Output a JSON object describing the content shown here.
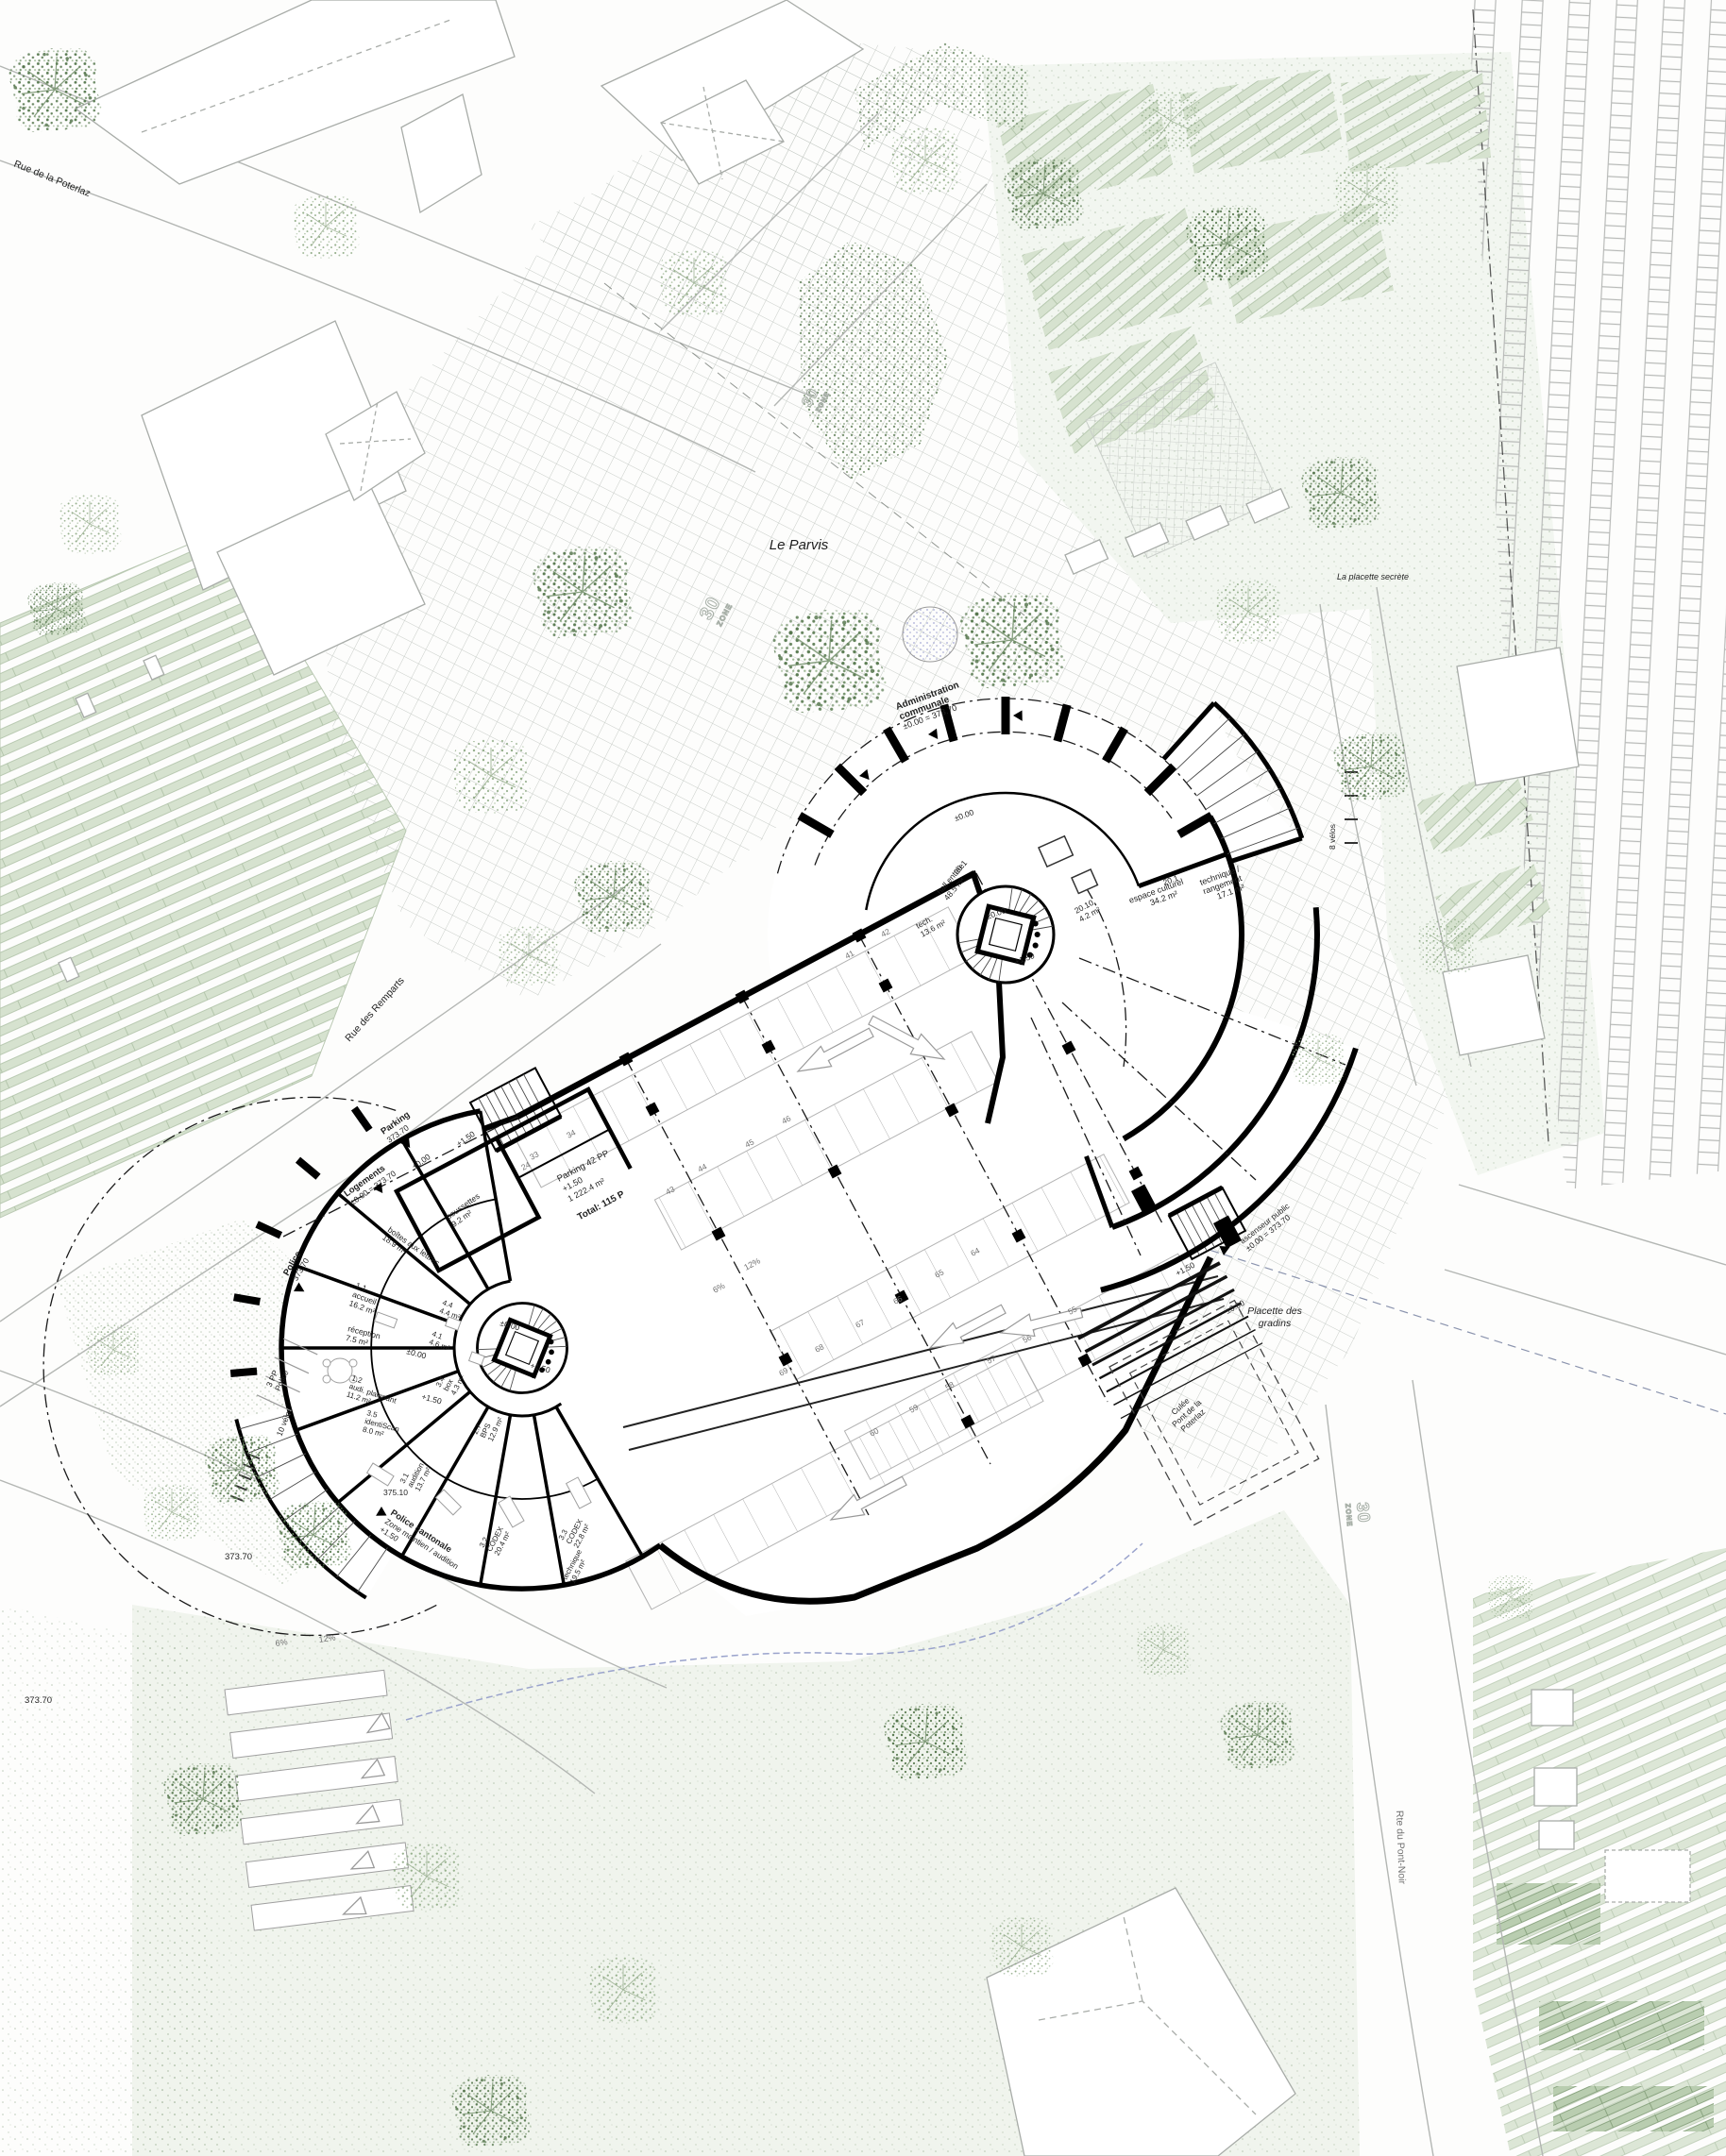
{
  "colors": {
    "wall": "#000000",
    "paving_grid": "#c8cdc8",
    "foliage_dark": "#5c7e54",
    "foliage_light": "#93ae8a",
    "lawn_dot": "#87a07f",
    "water": "#a7abd6",
    "road_line": "#b3b6b3"
  },
  "streets": {
    "rue_poterlaz": "Rue de la Poterlaz",
    "rue_remparts": "Rue des Remparts",
    "rte_pont_noir": "Rte du Pont-Noir"
  },
  "places": {
    "parvis": "Le Parvis",
    "placette_secrete": "La placette secrète",
    "gradins_1": "Placette des",
    "gradins_2": "gradins",
    "culee_1": "Culée",
    "culee_2": "Pont de la",
    "culee_3": "Poterlaz"
  },
  "annotations": {
    "admin_1": "Administration",
    "admin_2": "communale",
    "admin_3": "±0.00 = 373.70",
    "logements_1": "Logements",
    "logements_2": "±0.00 = 373.70",
    "parking_entry_1": "Parking",
    "parking_entry_2": "373.70",
    "police_corner_1": "Police",
    "police_corner_2": "373.70",
    "police_cantonale_1": "Police cantonale",
    "police_cantonale_2": "Zone maintien / audition",
    "police_cantonale_3": "+1.50",
    "ascenseur_1": "ascenseur public",
    "ascenseur_2": "±0.00 = 373.70",
    "pp_police_1": "3 PP",
    "pp_police_2": "Police",
    "velos_10": "10 vélos",
    "velos_8": "8 vélos",
    "zone": "ZONE",
    "zone_num": "30"
  },
  "levels": {
    "l_0": "±0.00",
    "l_150": "+1.50",
    "e_37370": "373.70",
    "e_37510": "375.10"
  },
  "parking": {
    "title": "Parking 42 PP",
    "level": "+1.50",
    "area": "1 222.4 m²",
    "total": "Total: 115 P",
    "slope_6": "6%",
    "slope_12": "12%",
    "stalls": {
      "s24": "24",
      "s33": "33",
      "s34": "34",
      "s41": "41",
      "s42": "42",
      "s43": "43",
      "s44": "44",
      "s45": "45",
      "s46": "46",
      "s55": "55",
      "s56": "56",
      "s57": "57",
      "s58": "58",
      "s59": "59",
      "s60": "60",
      "s64": "64",
      "s65": "65",
      "s66": "66",
      "s67": "67",
      "s68": "68",
      "s69": "69"
    }
  },
  "rooms_admin": {
    "hall_num": "20.1",
    "hall_name": "hall entrée",
    "hall_area": "48.5 m²",
    "tech_name": "tech.",
    "tech_area": "13.6 m²",
    "r2010_num": "20.10",
    "r2010_area": "4.2 m²",
    "culturel_num": "20.1",
    "culturel_name": "espace culturel",
    "culturel_area": "34.2 m²",
    "technique_1": "technique /",
    "technique_2": "rangement",
    "technique_area": "17.1 m²"
  },
  "rooms_police": {
    "accueil_num": "1.1",
    "accueil_name": "accueil",
    "accueil_area": "16.2 m²",
    "reception_name": "réception",
    "reception_area": "7.5 m²",
    "r44_num": "4.4",
    "r44_area": "4.4 m²",
    "r41_num": "4.1",
    "r41_area": "4.6 m²",
    "plaignant_num": "1.2",
    "plaignant_name": "audi. plaignant",
    "plaignant_area": "11.2 m²",
    "box_num": "3.4",
    "box_name": "box",
    "box_area": "4.3 m²",
    "identiscan_num": "3.5",
    "identiscan_name": "identiScan",
    "identiscan_area": "8.0 m²",
    "bps_num": "2.7",
    "bps_name": "BPS",
    "bps_area": "12.9 m²",
    "audition_num": "3.1",
    "audition_name": "audition",
    "audition_area": "13.7 m²",
    "codex1_num": "3.2",
    "codex1_name": "CODEX",
    "codex1_area": "20.4 m²",
    "codex2_num": "3.3",
    "codex2_name": "CODEX",
    "codex2_area": "22.8 m²",
    "technique_name": "technique",
    "technique_area": "19.5 m²",
    "poussettes_name": "poussettes",
    "poussettes_area": "9.2 m²",
    "lettres_name": "boîtes aux lettres",
    "lettres_area": "18.9 m²"
  }
}
